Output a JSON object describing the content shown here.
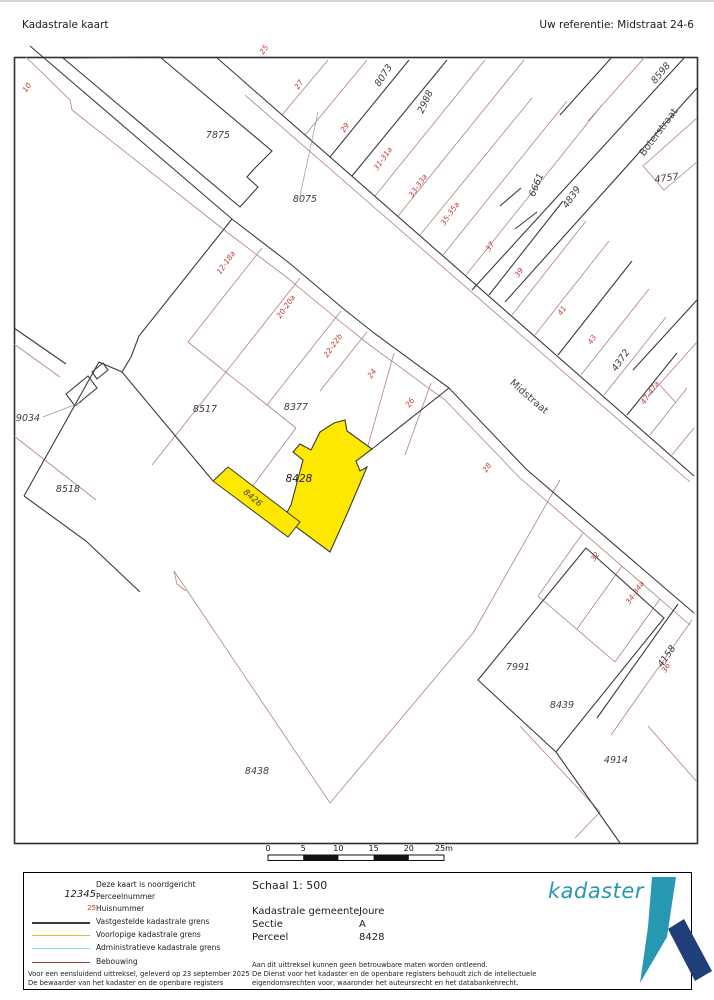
{
  "header": {
    "title": "Kadastrale kaart",
    "reference": "Uw referentie: Midstraat 24-6"
  },
  "map": {
    "highlight_parcel": "8428",
    "highlight_color": "#ffe800",
    "boundary_black": "#3b3b3d",
    "boundary_red": "#b2817e",
    "labels": [
      {
        "text": "7875",
        "x": 218,
        "y": 138,
        "rot": 0,
        "cls": "parcel"
      },
      {
        "text": "8075",
        "x": 305,
        "y": 202,
        "rot": 0,
        "cls": "parcel"
      },
      {
        "text": "8073",
        "x": 386,
        "y": 77,
        "rot": -57,
        "cls": "parcel"
      },
      {
        "text": "2988",
        "x": 428,
        "y": 103,
        "rot": -65,
        "cls": "parcel"
      },
      {
        "text": "8598",
        "x": 663,
        "y": 75,
        "rot": -50,
        "cls": "parcel"
      },
      {
        "text": "4757",
        "x": 667,
        "y": 181,
        "rot": -8,
        "cls": "parcel"
      },
      {
        "text": "6661",
        "x": 539,
        "y": 186,
        "rot": -68,
        "cls": "parcel"
      },
      {
        "text": "4839",
        "x": 574,
        "y": 199,
        "rot": -55,
        "cls": "parcel"
      },
      {
        "text": "4372",
        "x": 623,
        "y": 362,
        "rot": -55,
        "cls": "parcel"
      },
      {
        "text": "8517",
        "x": 205,
        "y": 412,
        "rot": 0,
        "cls": "parcel"
      },
      {
        "text": "8377",
        "x": 296,
        "y": 410,
        "rot": 0,
        "cls": "parcel"
      },
      {
        "text": "8428",
        "x": 299,
        "y": 482,
        "rot": 0,
        "cls": "parcel-highlight"
      },
      {
        "text": "8426",
        "x": 251,
        "y": 500,
        "rot": 40,
        "cls": "parcel-small"
      },
      {
        "text": "9034",
        "x": 28,
        "y": 421,
        "rot": 0,
        "cls": "parcel"
      },
      {
        "text": "8518",
        "x": 68,
        "y": 492,
        "rot": 0,
        "cls": "parcel"
      },
      {
        "text": "7991",
        "x": 518,
        "y": 670,
        "rot": 0,
        "cls": "parcel"
      },
      {
        "text": "8439",
        "x": 562,
        "y": 708,
        "rot": 0,
        "cls": "parcel"
      },
      {
        "text": "4158",
        "x": 669,
        "y": 658,
        "rot": -55,
        "cls": "parcel"
      },
      {
        "text": "4914",
        "x": 616,
        "y": 763,
        "rot": 0,
        "cls": "parcel"
      },
      {
        "text": "8438",
        "x": 257,
        "y": 774,
        "rot": 0,
        "cls": "parcel"
      },
      {
        "text": "Midstraat",
        "x": 527,
        "y": 399,
        "rot": 41,
        "cls": "street"
      },
      {
        "text": "Boterstraat",
        "x": 661,
        "y": 134,
        "rot": -53,
        "cls": "street"
      },
      {
        "text": "10",
        "x": 29,
        "y": 89,
        "rot": -55,
        "cls": "house"
      },
      {
        "text": "25",
        "x": 266,
        "y": 51,
        "rot": -55,
        "cls": "house"
      },
      {
        "text": "27",
        "x": 301,
        "y": 86,
        "rot": -55,
        "cls": "house"
      },
      {
        "text": "29",
        "x": 347,
        "y": 129,
        "rot": -55,
        "cls": "house"
      },
      {
        "text": "31-31a",
        "x": 385,
        "y": 160,
        "rot": -55,
        "cls": "house"
      },
      {
        "text": "33-33a",
        "x": 420,
        "y": 187,
        "rot": -55,
        "cls": "house"
      },
      {
        "text": "35-35a",
        "x": 452,
        "y": 215,
        "rot": -55,
        "cls": "house"
      },
      {
        "text": "37",
        "x": 492,
        "y": 248,
        "rot": -55,
        "cls": "house"
      },
      {
        "text": "39",
        "x": 521,
        "y": 274,
        "rot": -55,
        "cls": "house"
      },
      {
        "text": "41",
        "x": 564,
        "y": 312,
        "rot": -55,
        "cls": "house"
      },
      {
        "text": "43",
        "x": 594,
        "y": 341,
        "rot": -55,
        "cls": "house"
      },
      {
        "text": "47-47a",
        "x": 652,
        "y": 394,
        "rot": -55,
        "cls": "house"
      },
      {
        "text": "12-18a",
        "x": 228,
        "y": 264,
        "rot": -55,
        "cls": "house"
      },
      {
        "text": "20-20a",
        "x": 288,
        "y": 308,
        "rot": -55,
        "cls": "house"
      },
      {
        "text": "22-22b",
        "x": 335,
        "y": 347,
        "rot": -55,
        "cls": "house"
      },
      {
        "text": "24",
        "x": 374,
        "y": 375,
        "rot": -55,
        "cls": "house"
      },
      {
        "text": "26",
        "x": 412,
        "y": 404,
        "rot": -55,
        "cls": "house"
      },
      {
        "text": "28",
        "x": 489,
        "y": 469,
        "rot": -55,
        "cls": "house"
      },
      {
        "text": "32",
        "x": 597,
        "y": 558,
        "rot": -55,
        "cls": "house"
      },
      {
        "text": "34-34a",
        "x": 637,
        "y": 594,
        "rot": -55,
        "cls": "house"
      },
      {
        "text": "36",
        "x": 668,
        "y": 669,
        "rot": -60,
        "cls": "house"
      }
    ]
  },
  "scalebar": {
    "ticks": [
      "0",
      "5",
      "10",
      "15",
      "20",
      "25m"
    ]
  },
  "legend": {
    "north_note": "Deze kaart is noordgericht",
    "sample_parcel": "12345",
    "sample_parcel_label": "Perceelnummer",
    "sample_house": "25",
    "sample_house_label": "Huisnummer",
    "lines": [
      {
        "color": "#3a3a3c",
        "width": 2,
        "label": "Vastgestelde kadastrale grens"
      },
      {
        "color": "#d8c22c",
        "width": 1.5,
        "label": "Voorlopige kadastrale grens"
      },
      {
        "color": "#86d7e8",
        "width": 1.5,
        "label": "Administratieve kadastrale grens"
      },
      {
        "color": "#a03a33",
        "width": 1.5,
        "label": "Bebouwing"
      }
    ],
    "footnote1": "Voor een eensluidend uittreksel, geleverd op 23 september 2025",
    "footnote2": "De bewaarder van het kadaster en de openbare registers"
  },
  "info": {
    "schaal": "Schaal 1: 500",
    "rows": [
      {
        "label": "Kadastrale gemeente",
        "value": "Joure"
      },
      {
        "label": "Sectie",
        "value": "A"
      },
      {
        "label": "Perceel",
        "value": "8428"
      }
    ],
    "disclaimer1": "Aan dit uittreksel kunnen geen betrouwbare maten worden ontleend.",
    "disclaimer2": "De Dienst voor het kadaster en de openbare registers behoudt zich de intellectuele",
    "disclaimer3": "eigendomsrechten voor, waaronder het auteursrecht en het databankenrecht.",
    "logo_text": "kadaster",
    "logo_teal": "#2798b2",
    "logo_navy": "#1f3e7a"
  }
}
